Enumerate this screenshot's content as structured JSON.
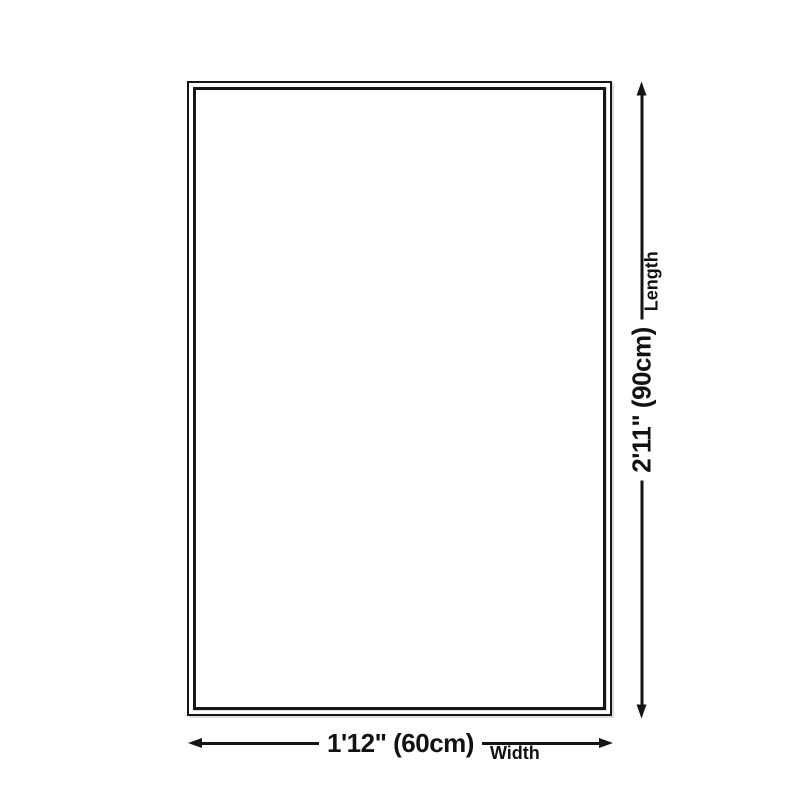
{
  "page": {
    "background_color": "#ffffff",
    "ink_color": "#141414"
  },
  "diagram": {
    "shape": "rectangle-double-border",
    "length": {
      "value": "2'11\" (90cm)",
      "label": "Length"
    },
    "width": {
      "value": "1'12\" (60cm)",
      "label": "Width"
    }
  }
}
